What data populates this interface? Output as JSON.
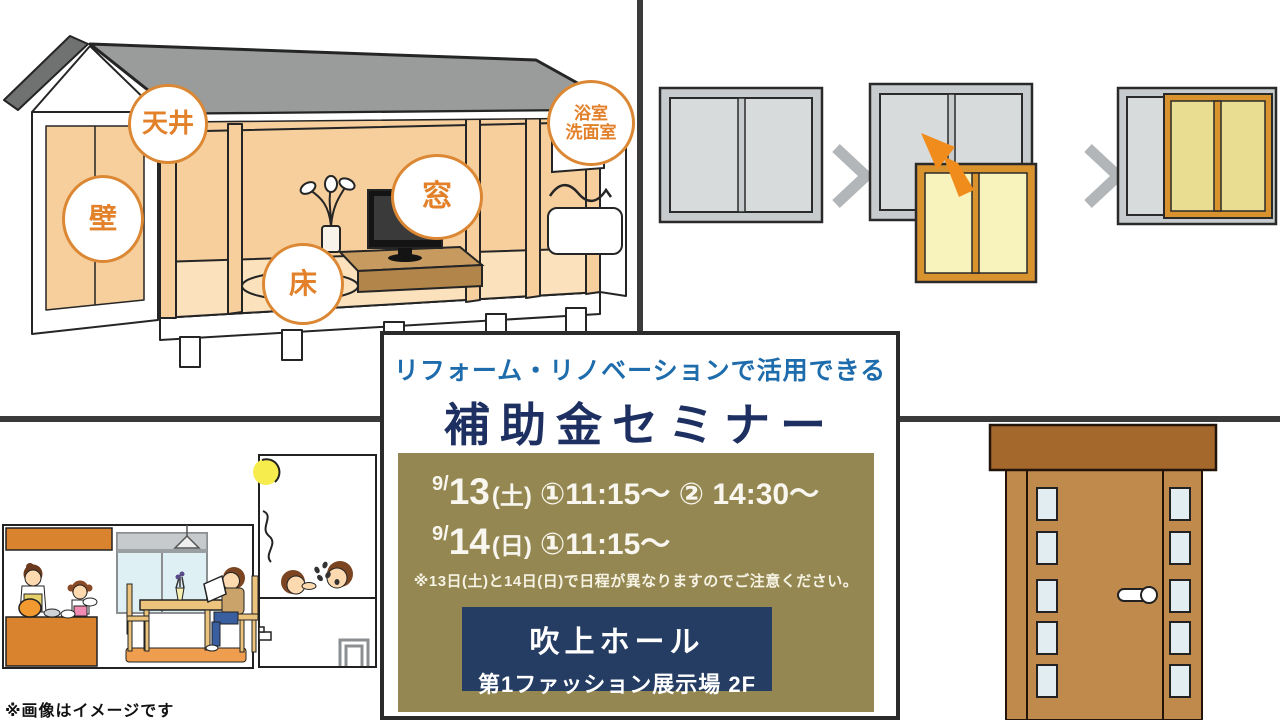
{
  "colors": {
    "accent_orange": "#e2812a",
    "title_navy": "#1d3061",
    "subtitle_blue": "#1e6cab",
    "schedule_bg_olive": "#948751",
    "venue_bg_navy": "#253c63",
    "divider_gray": "#3a3a3a"
  },
  "house": {
    "labels": {
      "ceiling": {
        "text": "天井"
      },
      "wall": {
        "text": "壁"
      },
      "window": {
        "text": "窓"
      },
      "floor": {
        "text": "床"
      },
      "bath": {
        "line1": "浴室",
        "line2": "洗面室"
      }
    }
  },
  "seminar": {
    "subtitle": "リフォーム・リノベーションで活用できる",
    "title": "補助金セミナー",
    "schedule": [
      {
        "month": "9/",
        "day": "13",
        "weekday": "(土)",
        "times": "①11:15～ ② 14:30～"
      },
      {
        "month": "9/",
        "day": "14",
        "weekday": "(日)",
        "times": "①11:15～"
      }
    ],
    "note": "※13日(土)と14日(日)で日程が異なりますのでご注意ください。",
    "venue": {
      "name": "吹上ホール",
      "hall": "第1ファッション展示場 2F"
    }
  },
  "footer": {
    "note": "※画像はイメージです"
  }
}
